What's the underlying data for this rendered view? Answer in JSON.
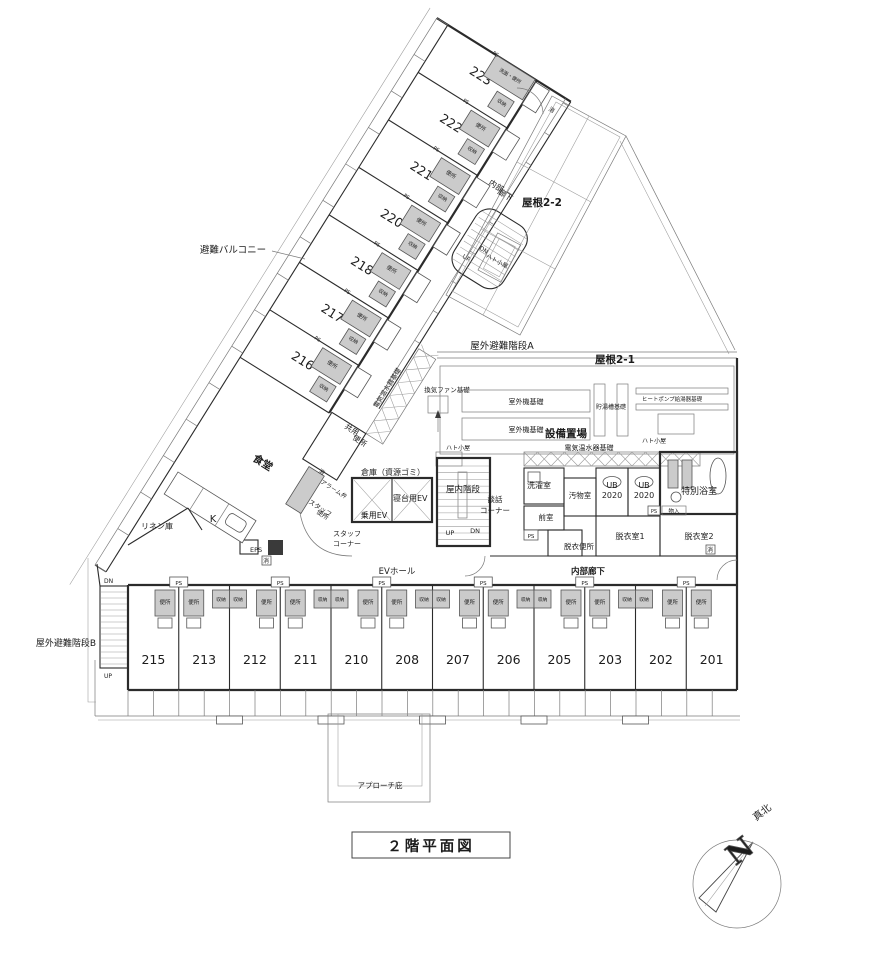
{
  "drawing_title": "２階平面図",
  "compass": {
    "n": "N",
    "true_north": "真北"
  },
  "rooms": {
    "wing": [
      "216",
      "217",
      "218",
      "220",
      "221",
      "222",
      "223"
    ],
    "south": [
      "215",
      "213",
      "212",
      "211",
      "210",
      "208",
      "207",
      "206",
      "205",
      "203",
      "202",
      "201"
    ]
  },
  "labels": {
    "evac_balcony": "避難バルコニー",
    "outdoor_stair_a": "屋外避難階段A",
    "outdoor_stair_b": "屋外避難階段B",
    "indoor_stair": "屋内階段",
    "roof_2_2": "屋根2-2",
    "roof_2_1": "屋根2-1",
    "inner_corridor": "内部廊下",
    "inner_corridor_l1": "内部",
    "inner_corridor_l2": "廊下",
    "equipment_yard": "設備置場",
    "outdoor_unit_base": "室外機基礎",
    "storage_tank_base": "貯湯槽基礎",
    "heat_pump_base": "ヒートポンプ給湯器基礎",
    "electric_heater_base": "電気温水器基礎",
    "vent_fan_base": "換気ファン基礎",
    "pigeon_hut": "ハト小屋",
    "laundry": "洗濯室",
    "soiled_room": "汚物室",
    "ub_l1": "UB",
    "ub_l2": "2020",
    "special_bath": "特別浴室",
    "anteroom": "前室",
    "undressing1": "脱衣室1",
    "undressing2": "脱衣室2",
    "undressing_toilet": "脱衣便所",
    "storage_in": "物入",
    "talk_l1": "談話",
    "talk_l2": "コーナー",
    "bed_elevator": "寝台用EV",
    "passenger_elevator": "乗用EV",
    "ev_hall": "EVホール",
    "warehouse": "倉庫（資源ゴミ）",
    "shared_l1": "共用",
    "shared_l2": "便所",
    "staff_toilet_l1": "スタッフ",
    "staff_toilet_l2": "便所",
    "alarm_l1": "消",
    "alarm_l2": "アラーム弁",
    "staff_corner_l1": "スタッフ",
    "staff_corner_l2": "コーナー",
    "dining": "食堂",
    "kitchen": "K",
    "linen": "リネン庫",
    "eps": "EPS",
    "ext_mark": "消",
    "approach_canopy": "アプローチ庇",
    "up": "UP",
    "dn": "DN",
    "toilet": "便所",
    "closet": "収納",
    "ps": "PS",
    "wash_toilet": "洗面・便所"
  }
}
